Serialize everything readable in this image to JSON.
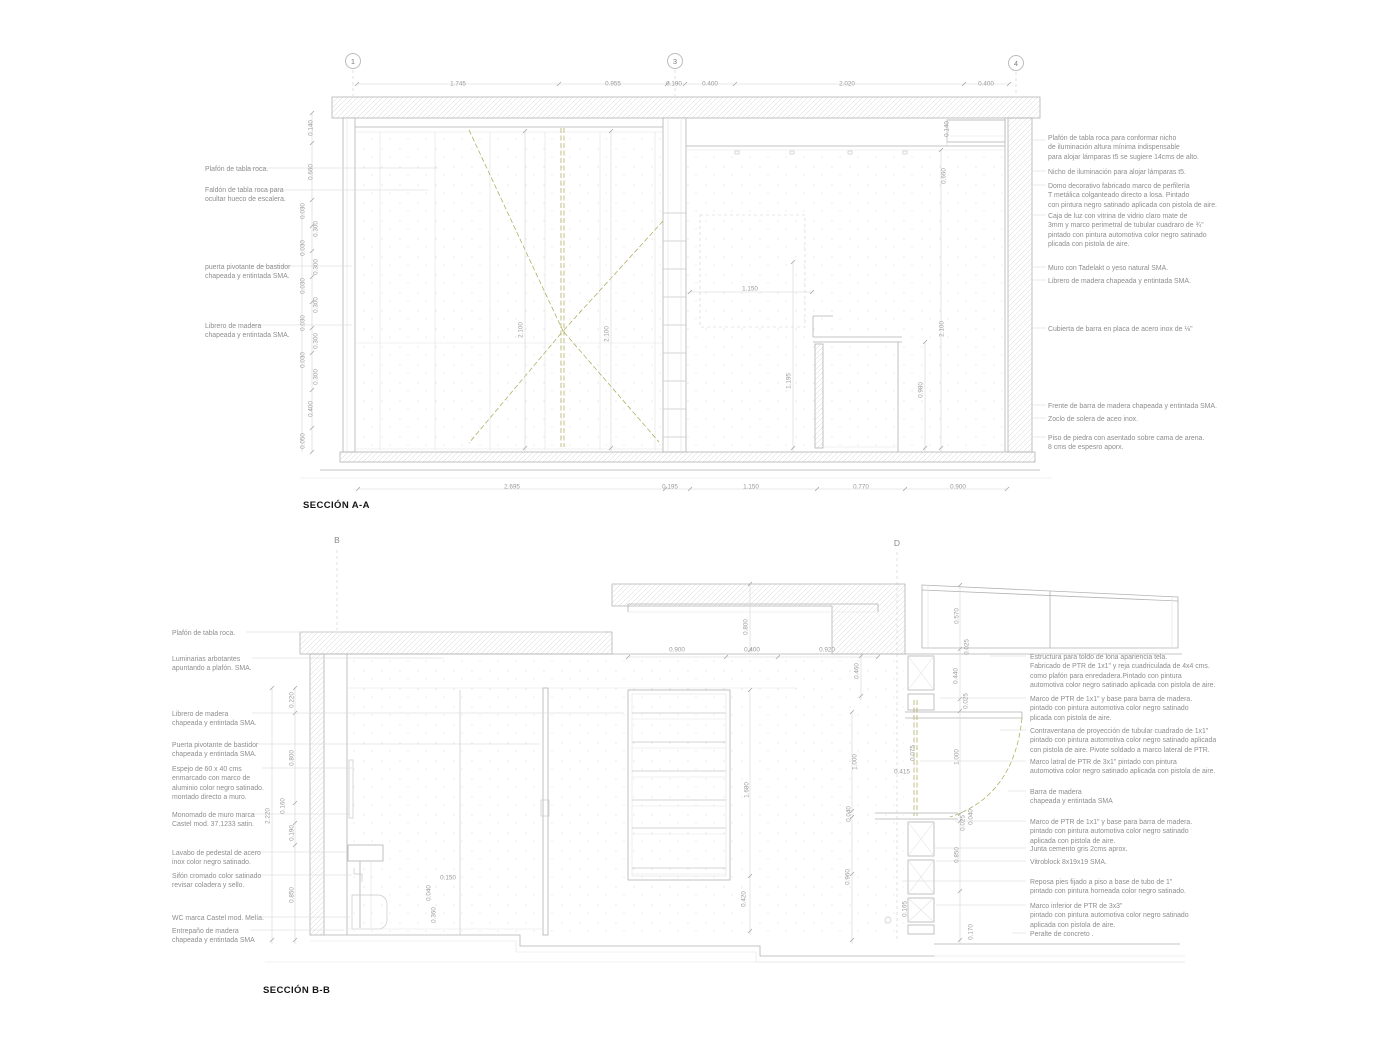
{
  "palette": {
    "line": "#b3b3b3",
    "faint": "#e2e2e2",
    "text": "#8e8e8e",
    "olive": "#a9a552",
    "title": "#161616",
    "background": "#ffffff"
  },
  "section_a": {
    "title": "SECCIÓN A-A",
    "grid_markers": [
      {
        "text": "1",
        "x": 353,
        "y": 61
      },
      {
        "text": "3",
        "x": 675,
        "y": 61
      },
      {
        "text": "4",
        "x": 1016,
        "y": 63
      }
    ],
    "dims": [
      {
        "text": "1.745",
        "x": 458,
        "y": 84
      },
      {
        "text": "0.955",
        "x": 613,
        "y": 84
      },
      {
        "text": "0.190",
        "x": 674,
        "y": 84
      },
      {
        "text": "0.400",
        "x": 710,
        "y": 84
      },
      {
        "text": "2.020",
        "x": 847,
        "y": 84
      },
      {
        "text": "0.400",
        "x": 986,
        "y": 84
      },
      {
        "text": "2.695",
        "x": 512,
        "y": 487
      },
      {
        "text": "0.195",
        "x": 670,
        "y": 487
      },
      {
        "text": "1.150",
        "x": 751,
        "y": 487
      },
      {
        "text": "0.770",
        "x": 861,
        "y": 487
      },
      {
        "text": "0.900",
        "x": 958,
        "y": 487
      },
      {
        "text": "0.140",
        "x": 311,
        "y": 128,
        "rot": true
      },
      {
        "text": "0.660",
        "x": 311,
        "y": 172,
        "rot": true
      },
      {
        "text": "0.030",
        "x": 303,
        "y": 211,
        "rot": true
      },
      {
        "text": "0.300",
        "x": 316,
        "y": 229,
        "rot": true
      },
      {
        "text": "0.030",
        "x": 303,
        "y": 248,
        "rot": true
      },
      {
        "text": "0.300",
        "x": 316,
        "y": 267,
        "rot": true
      },
      {
        "text": "0.030",
        "x": 303,
        "y": 286,
        "rot": true
      },
      {
        "text": "0.300",
        "x": 316,
        "y": 305,
        "rot": true
      },
      {
        "text": "0.030",
        "x": 303,
        "y": 323,
        "rot": true
      },
      {
        "text": "0.300",
        "x": 316,
        "y": 341,
        "rot": true
      },
      {
        "text": "0.030",
        "x": 303,
        "y": 360,
        "rot": true
      },
      {
        "text": "0.300",
        "x": 316,
        "y": 377,
        "rot": true
      },
      {
        "text": "0.400",
        "x": 311,
        "y": 409,
        "rot": true
      },
      {
        "text": "0.050",
        "x": 303,
        "y": 441,
        "rot": true
      },
      {
        "text": "2.100",
        "x": 521,
        "y": 330,
        "rot": true
      },
      {
        "text": "2.100",
        "x": 607,
        "y": 334,
        "rot": true
      },
      {
        "text": "1.150",
        "x": 750,
        "y": 289
      },
      {
        "text": "1.195",
        "x": 789,
        "y": 381,
        "rot": true
      },
      {
        "text": "0.980",
        "x": 921,
        "y": 390,
        "rot": true
      },
      {
        "text": "2.100",
        "x": 942,
        "y": 329,
        "rot": true
      },
      {
        "text": "0.140",
        "x": 947,
        "y": 129,
        "rot": true
      },
      {
        "text": "0.660",
        "x": 944,
        "y": 176,
        "rot": true
      }
    ],
    "labels_left": [
      {
        "text": "Plafón de tabla roca.",
        "x": 205,
        "y": 165
      },
      {
        "text": "Faldón de tabla roca para\nocultar hueco de escalera.",
        "x": 205,
        "y": 186
      },
      {
        "text": "puerta pivotante de bastidor\nchapeada y entintada SMA.",
        "x": 205,
        "y": 263
      },
      {
        "text": "Librero de madera\nchapeada y entintada SMA.",
        "x": 205,
        "y": 322
      }
    ],
    "labels_right": [
      {
        "text": "Plafón de tabla roca para conformar nicho\nde iluminación altura mínima indispensable\npara alojar lámparas t5 se sugiere 14cms de alto.",
        "x": 1048,
        "y": 134
      },
      {
        "text": "Nicho de iluminación para alojar lámparas t5.",
        "x": 1048,
        "y": 168
      },
      {
        "text": "Domo decorativo fabricado marco de perfilería\nT metálica colganteado directo a losa. Pintado\ncon pintura negro satinado aplicada con pistola de aire.",
        "x": 1048,
        "y": 182
      },
      {
        "text": "Caja de luz con vitrina de vidrio claro mate de\n3mm y marco perimetral de tubular cuadraro de ¾\"\npintado con pintura automotiva color negro satinado\nplicada con pistola de aire.",
        "x": 1048,
        "y": 212
      },
      {
        "text": "Muro con Tadelakt o yeso natural SMA.",
        "x": 1048,
        "y": 264
      },
      {
        "text": "Librero de madera chapeada y entintada SMA.",
        "x": 1048,
        "y": 277
      },
      {
        "text": "Cubierta de barra en placa de acero inox de ⅛\"",
        "x": 1048,
        "y": 325
      },
      {
        "text": "Frente de barra de madera chapeada y entintada SMA.",
        "x": 1048,
        "y": 402
      },
      {
        "text": "Zoclo de solera de aceo inox.",
        "x": 1048,
        "y": 415
      },
      {
        "text": "Piso de piedra con asentado sobre cama de arena.\n8 cms de espesro aporx.",
        "x": 1048,
        "y": 434
      }
    ]
  },
  "section_b": {
    "title": "SECCIÓN B-B",
    "markers": [
      {
        "text": "B",
        "x": 337,
        "y": 540
      },
      {
        "text": "D",
        "x": 897,
        "y": 543
      }
    ],
    "dims": [
      {
        "text": "0.900",
        "x": 677,
        "y": 650
      },
      {
        "text": "0.400",
        "x": 752,
        "y": 650
      },
      {
        "text": "0.920",
        "x": 827,
        "y": 650
      },
      {
        "text": "0.800",
        "x": 746,
        "y": 627,
        "rot": true
      },
      {
        "text": "0.460",
        "x": 857,
        "y": 671,
        "rot": true
      },
      {
        "text": "0.570",
        "x": 957,
        "y": 616,
        "rot": true
      },
      {
        "text": "0.025",
        "x": 967,
        "y": 647,
        "rot": true
      },
      {
        "text": "0.440",
        "x": 956,
        "y": 676,
        "rot": true
      },
      {
        "text": "0.025",
        "x": 966,
        "y": 701,
        "rot": true
      },
      {
        "text": "1.000",
        "x": 855,
        "y": 762,
        "rot": true
      },
      {
        "text": "0.075",
        "x": 913,
        "y": 753,
        "rot": true
      },
      {
        "text": "0.415",
        "x": 902,
        "y": 772
      },
      {
        "text": "1.000",
        "x": 957,
        "y": 757,
        "rot": true
      },
      {
        "text": "0.040",
        "x": 849,
        "y": 814,
        "rot": true
      },
      {
        "text": "0.025",
        "x": 963,
        "y": 823,
        "rot": true
      },
      {
        "text": "0.040",
        "x": 971,
        "y": 817,
        "rot": true
      },
      {
        "text": "0.850",
        "x": 957,
        "y": 855,
        "rot": true
      },
      {
        "text": "0.960",
        "x": 848,
        "y": 877,
        "rot": true
      },
      {
        "text": "0.165",
        "x": 905,
        "y": 909,
        "rot": true
      },
      {
        "text": "0.170",
        "x": 971,
        "y": 932,
        "rot": true
      },
      {
        "text": "1.680",
        "x": 747,
        "y": 790,
        "rot": true
      },
      {
        "text": "0.420",
        "x": 744,
        "y": 899,
        "rot": true
      },
      {
        "text": "0.150",
        "x": 448,
        "y": 878
      },
      {
        "text": "0.040",
        "x": 429,
        "y": 893,
        "rot": true
      },
      {
        "text": "0.360",
        "x": 434,
        "y": 915,
        "rot": true
      },
      {
        "text": "0.220",
        "x": 292,
        "y": 700,
        "rot": true
      },
      {
        "text": "0.800",
        "x": 292,
        "y": 758,
        "rot": true
      },
      {
        "text": "2.220",
        "x": 268,
        "y": 816,
        "rot": true
      },
      {
        "text": "0.160",
        "x": 283,
        "y": 806,
        "rot": true
      },
      {
        "text": "0.190",
        "x": 292,
        "y": 833,
        "rot": true
      },
      {
        "text": "0.850",
        "x": 292,
        "y": 895,
        "rot": true
      }
    ],
    "labels_left": [
      {
        "text": "Plafón de tabla roca.",
        "x": 172,
        "y": 629
      },
      {
        "text": "Luminarias arbotantes\napuntando a plafón. SMA.",
        "x": 172,
        "y": 655
      },
      {
        "text": "Librero de madera\nchapeada y entintada SMA.",
        "x": 172,
        "y": 710
      },
      {
        "text": "Puerta pivotante de bastidor\nchapeada y entintada SMA.",
        "x": 172,
        "y": 741
      },
      {
        "text": "Espejo de 60 x 40 cms\nenmarcado con marco de\naluminio color negro satinado.\nmontado directo a muro.",
        "x": 172,
        "y": 765
      },
      {
        "text": "Monomado de muro marca\nCastel mod. 37.1233 satin.",
        "x": 172,
        "y": 811
      },
      {
        "text": "Lavabo de pedestal de acero\ninox color negro satinado.",
        "x": 172,
        "y": 849
      },
      {
        "text": "Sifón cromado color satinado\nrevisar coladera y sello.",
        "x": 172,
        "y": 872
      },
      {
        "text": "WC marca Castel mod. Melía.",
        "x": 172,
        "y": 914
      },
      {
        "text": "Entrepaño  de madera\nchapeada y entintada SMA",
        "x": 172,
        "y": 927
      }
    ],
    "labels_right": [
      {
        "text": "Estructura para toldo de lona apariencia tela.\nFabricado de PTR de 1x1\" y reja cuadriculada de 4x4 cms.\ncomo plafón para enredadera.Pintado con pintura\nautomotiva color negro satinado aplicada con pistola de aire.",
        "x": 1030,
        "y": 653
      },
      {
        "text": "Marco de PTR de 1x1\" y base para barra de madera.\npintado con pintura automotiva color negro satinado\nplicada con pistola de aire.",
        "x": 1030,
        "y": 695
      },
      {
        "text": "Contraventana de proyección de tubular cuadrado de 1x1\"\npintado con pintura automotiva color negro satinado aplicada\ncon pistola de aire. Pivote soldado a marco lateral de PTR.",
        "x": 1030,
        "y": 727
      },
      {
        "text": "Marco latral de PTR de 3x1\" pintado con pintura\nautomotiva color negro satinado aplicada con pistola de aire.",
        "x": 1030,
        "y": 758
      },
      {
        "text": "Barra  de madera\nchapeada y entintada SMA",
        "x": 1030,
        "y": 788
      },
      {
        "text": "Marco de PTR de 1x1\" y base para barra de madera.\npintado con pintura automotiva color negro satinado\naplicada con pistola de aire.",
        "x": 1030,
        "y": 818
      },
      {
        "text": "Junta cemento gris 2cms aprox.",
        "x": 1030,
        "y": 845
      },
      {
        "text": "Vitroblock 8x19x19 SMA.",
        "x": 1030,
        "y": 858
      },
      {
        "text": "Reposa pies fijado a piso a base de tubo de 1\"\npintado con pintura horneada color negro satinado.",
        "x": 1030,
        "y": 878
      },
      {
        "text": "Marco inferior de PTR de 3x3\"\npintado con pintura automotiva color negro satinado\naplicada con pistola de aire.",
        "x": 1030,
        "y": 902
      },
      {
        "text": "Peralte de concreto .",
        "x": 1030,
        "y": 930
      }
    ]
  }
}
